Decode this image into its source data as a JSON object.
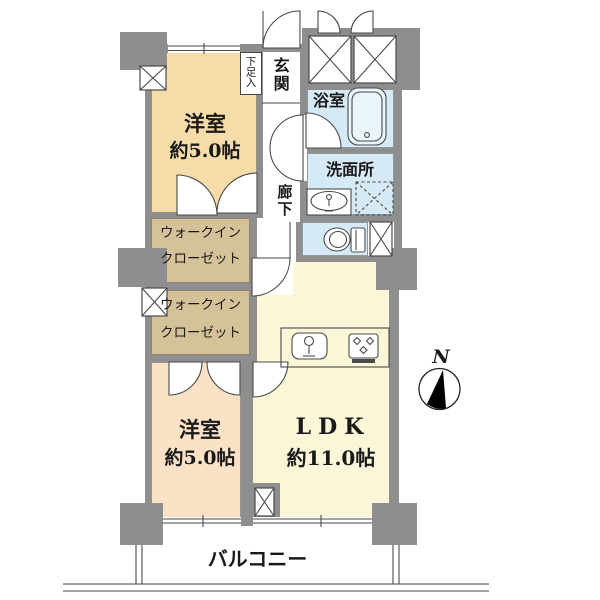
{
  "floorplan": {
    "compass": {
      "label": "N"
    },
    "balcony": {
      "label": "バルコニー"
    },
    "entrance": {
      "label": "玄関"
    },
    "shoe_cabinet": {
      "label": "下足入"
    },
    "hallway": {
      "label": "廊下"
    },
    "bathroom": {
      "label": "浴室"
    },
    "washroom": {
      "label": "洗面所"
    },
    "bedroom_top": {
      "label": "洋室",
      "size": "約5.0帖"
    },
    "bedroom_bottom": {
      "label": "洋室",
      "size": "約5.0帖"
    },
    "ldk": {
      "label": "LDK",
      "size": "約11.0帖"
    },
    "wic_top": {
      "line1": "ウォークイン",
      "line2": "クローゼット"
    },
    "wic_bottom": {
      "line1": "ウォークイン",
      "line2": "クローゼット"
    },
    "colors": {
      "wall": "#8E8E8E",
      "bedroom_top_floor": "#F5DCA8",
      "bedroom_bottom_floor": "#FBE1C6",
      "ldk_floor": "#FCF6D8",
      "closet_floor": "#D6C298",
      "wet_area_floor": "#D6EAF6"
    }
  }
}
